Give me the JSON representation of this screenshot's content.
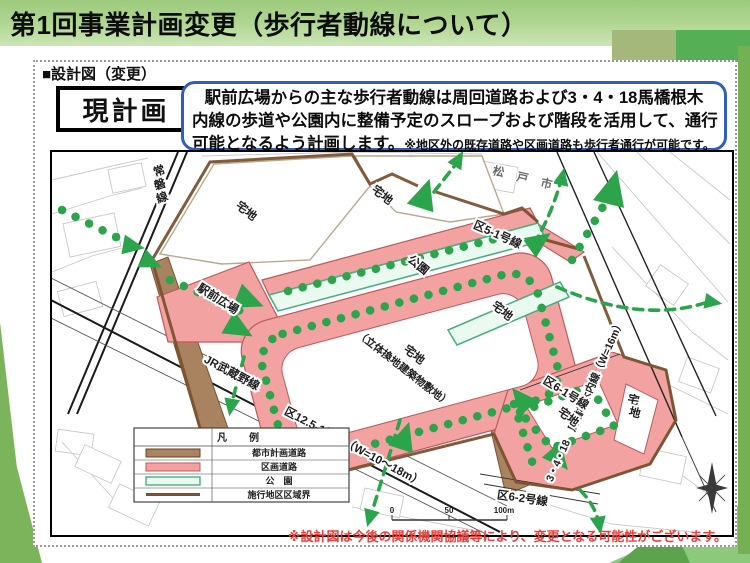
{
  "slide": {
    "title": "第1回事業計画変更（歩行者動線について）",
    "section_heading": "■設計図（変更）",
    "plan_label": "現計画",
    "callout": {
      "line1": "駅前広場からの主な歩行者動線は周回道路および3・4・18馬橋根木",
      "line2": "内線の歩道や公園内に整備予定のスロープおよび階段を活用して、通行",
      "line3_main": "可能となるよう計画します。",
      "line3_note": "※地区外の既存道路や区画道路も歩行者通行が可能です。"
    },
    "footnote": "※設計図は今後の関係機関協議等により、変更となる可能性がございます。"
  },
  "map": {
    "labels": {
      "joban_chars": [
        "常",
        "磐",
        "線"
      ],
      "musashino_line": "JR武蔵野線",
      "matsudo_city": "松 戸 市",
      "takuchi_top_left": "宅地",
      "takuchi_top_mid": "宅地",
      "station_plaza": "駅前広場",
      "central_parcel_1": "宅地",
      "central_parcel_2": "（立体換地建築物敷地）",
      "park": "公園",
      "takuchi_band": "宅地",
      "ku5_1": "区5-1号線",
      "mabashi_road": "3・4・18　馬橋根木内線（W=16m）",
      "ku6_1": "区6-1号線",
      "ku6_2": "区6-2号線",
      "takuchi_lower": "宅地",
      "takuchi_lower_v_chars": [
        "宅",
        "地"
      ],
      "ku12_5_1": "区12.5-1号線（W=10～18m）"
    },
    "legend": {
      "title": "凡　例",
      "items": [
        {
          "label": "都市計画道路",
          "color": "#a9835f"
        },
        {
          "label": "区画道路",
          "color": "#f4a0a0"
        },
        {
          "label": "公　園",
          "color": "#eafaf1"
        },
        {
          "label": "施行地区区域界",
          "color": "#7a5230"
        }
      ]
    },
    "scale": {
      "t0": "0",
      "t50": "50",
      "t100": "100m"
    }
  },
  "colors": {
    "banner_green": "#9cca7c",
    "accent_bright_green": "#55af55",
    "route_green": "#2ca44b",
    "road_pink": "#f2a3a1",
    "plan_road_brown": "#a9835f",
    "park_mint": "#eafaf1",
    "callout_border_blue": "#2e5fc0",
    "footnote_red": "#e8403a"
  }
}
